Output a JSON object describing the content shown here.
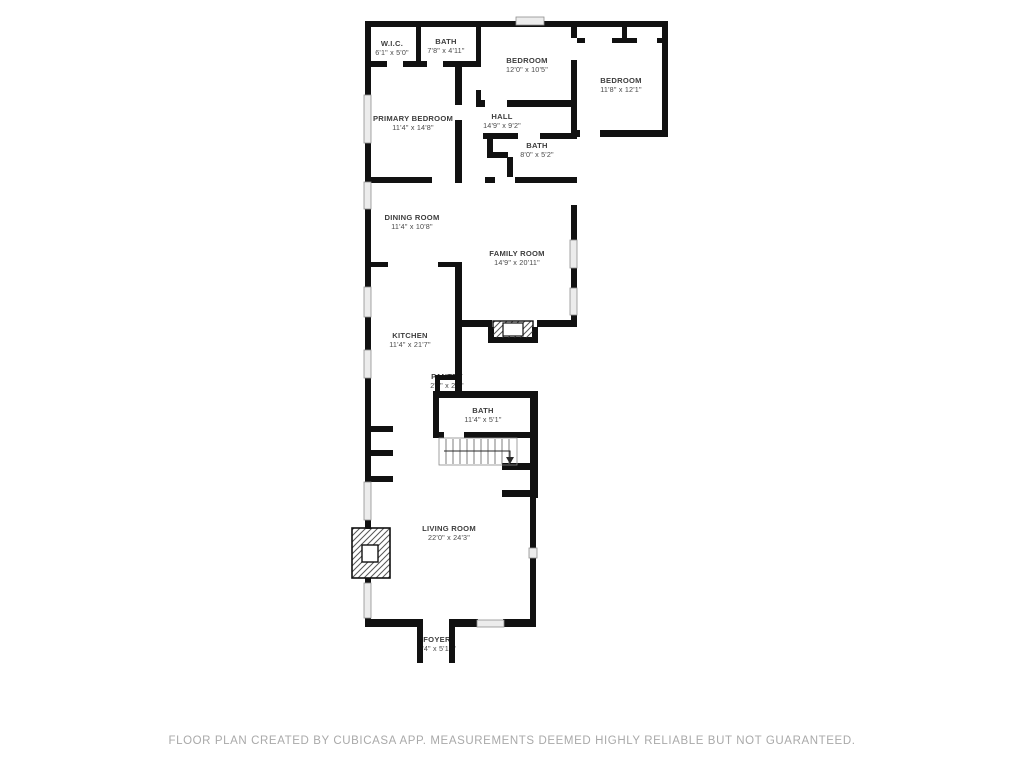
{
  "floor_plan": {
    "rooms": [
      {
        "id": "wic",
        "name": "W.I.C.",
        "dims": "6'1\" x 5'0\""
      },
      {
        "id": "bath-top",
        "name": "BATH",
        "dims": "7'8\" x 4'11\""
      },
      {
        "id": "bedroom-middle",
        "name": "BEDROOM",
        "dims": "12'0\" x 10'5\""
      },
      {
        "id": "bedroom-right",
        "name": "BEDROOM",
        "dims": "11'8\" x 12'1\""
      },
      {
        "id": "primary-bedroom",
        "name": "PRIMARY BEDROOM",
        "dims": "11'4\" x 14'8\""
      },
      {
        "id": "hall",
        "name": "HALL",
        "dims": "14'9\" x 9'2\""
      },
      {
        "id": "bath-hall",
        "name": "BATH",
        "dims": "8'0\" x 5'2\""
      },
      {
        "id": "dining-room",
        "name": "DINING ROOM",
        "dims": "11'4\" x 10'8\""
      },
      {
        "id": "family-room",
        "name": "FAMILY ROOM",
        "dims": "14'9\" x 20'11\""
      },
      {
        "id": "kitchen",
        "name": "KITCHEN",
        "dims": "11'4\" x 21'7\""
      },
      {
        "id": "pantry",
        "name": "PANTRY",
        "dims": "2'8\" x 2'8\""
      },
      {
        "id": "bath-main",
        "name": "BATH",
        "dims": "11'4\" x 5'1\""
      },
      {
        "id": "living-room",
        "name": "LIVING ROOM",
        "dims": "22'0\" x 24'3\""
      },
      {
        "id": "foyer",
        "name": "FOYER",
        "dims": "7'4\" x 5'10\""
      }
    ],
    "colors": {
      "wall": "#111111",
      "window_fill": "#ececec",
      "window_border": "#8f8f8f",
      "label_text": "#3d3d3d",
      "footer_text": "#a9a9a9",
      "background": "#ffffff"
    }
  },
  "footer": {
    "disclaimer": "FLOOR PLAN CREATED BY CUBICASA APP. MEASUREMENTS DEEMED HIGHLY RELIABLE BUT NOT GUARANTEED."
  }
}
